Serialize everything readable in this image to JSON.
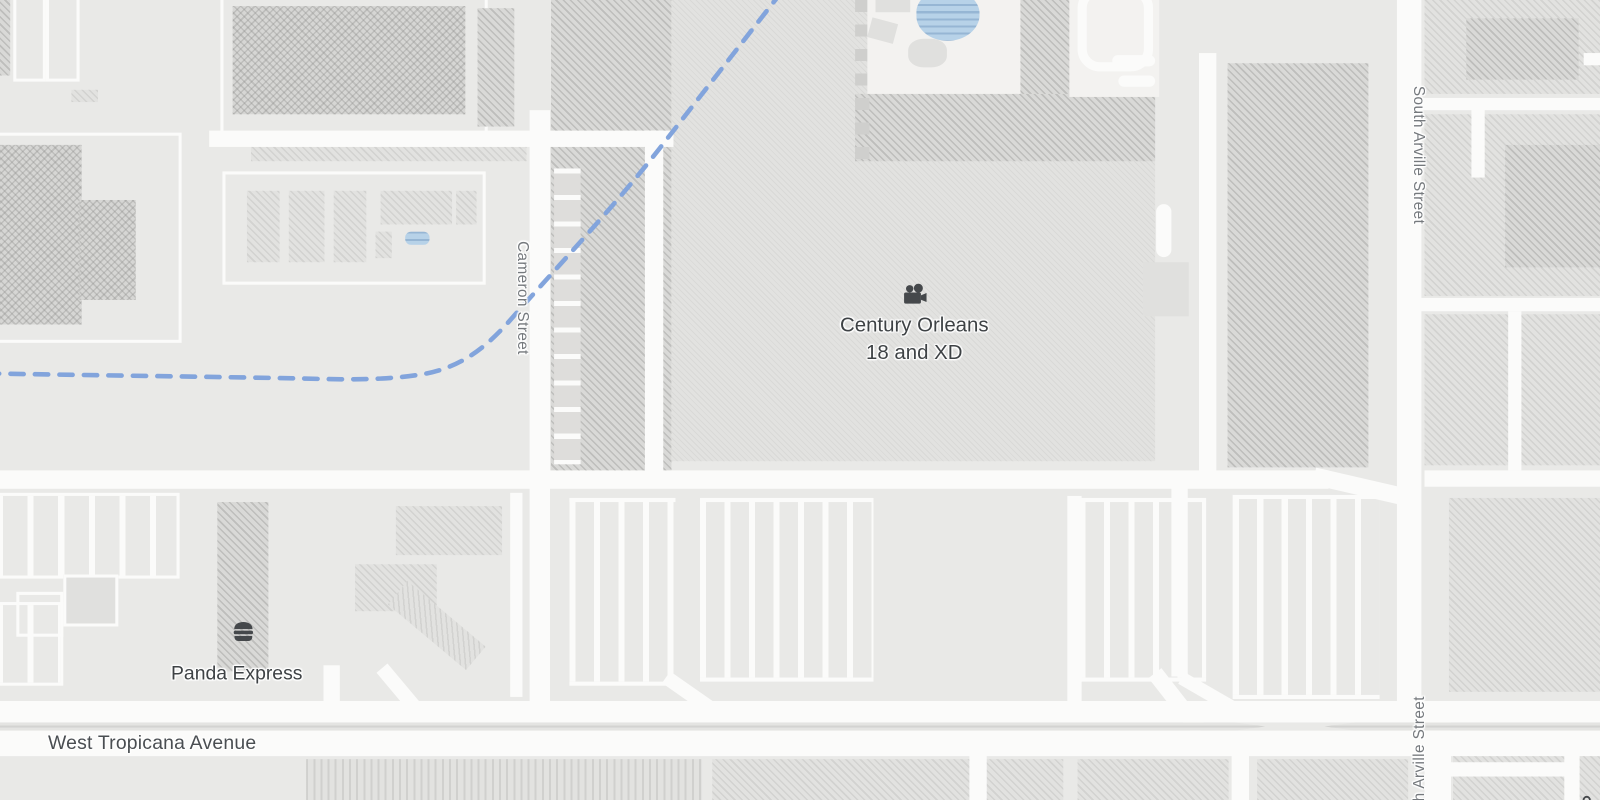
{
  "labels": {
    "poi_theater_line1": "Century Orleans",
    "poi_theater_line2": "18 and XD",
    "poi_restaurant": "Panda Express",
    "street_cameron": "Cameron Street",
    "street_arville_north": "South Arville Street",
    "street_arville_south": "South Arville Street",
    "street_tropicana": "West Tropicana Avenue"
  },
  "icons": {
    "theater": "movie-camera-icon",
    "restaurant": "hamburger-icon",
    "store": "shopping-bag-icon"
  },
  "colors": {
    "bg": "#e9e9e7",
    "road": "#fbfbfa",
    "water": "#b7d2e8",
    "trail": "#82a4dc",
    "street-label": "#75797d",
    "poi-label": "#3e4245",
    "icon-fill": "#45484b"
  }
}
